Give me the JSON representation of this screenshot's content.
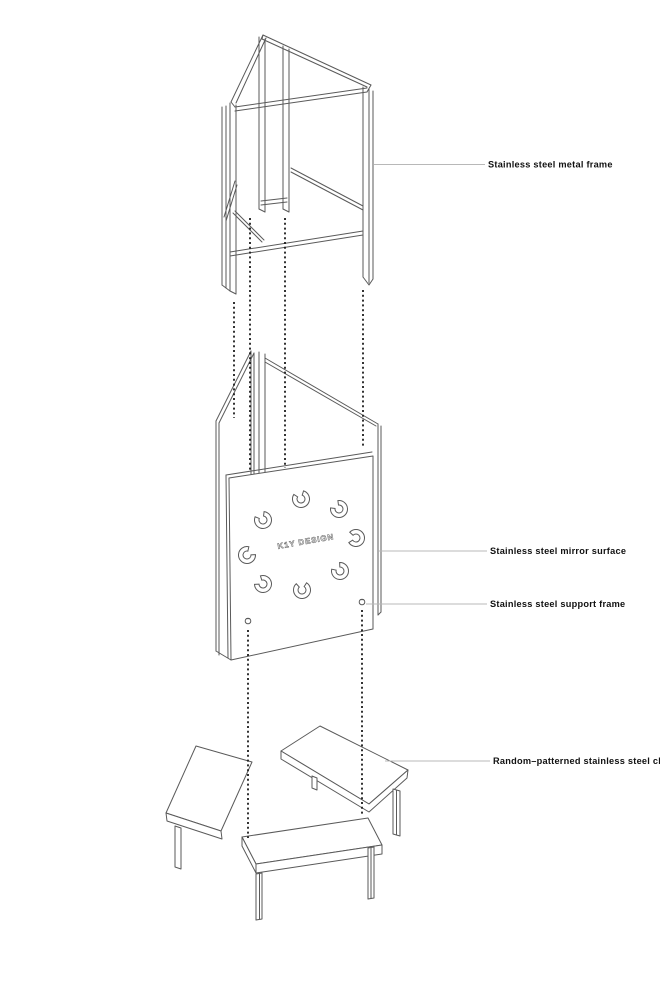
{
  "colors": {
    "line": "#5a5a5a",
    "leader": "#b8b8b8",
    "label_text": "#111111",
    "dotted": "#1c1c1c",
    "background": "#ffffff"
  },
  "annotations": [
    {
      "text": "Stainless steel metal frame"
    },
    {
      "text": "Stainless steel mirror surface"
    },
    {
      "text": "Stainless steel support frame"
    },
    {
      "text": "Random–patterned stainless steel chair"
    }
  ],
  "mirror_panel": {
    "brand_text": "K1Y DESIGN",
    "rings": [
      {
        "cx": 301,
        "cy": 499,
        "rot": 250
      },
      {
        "cx": 339,
        "cy": 509,
        "rot": 225
      },
      {
        "cx": 263,
        "cy": 520,
        "rot": 240
      },
      {
        "cx": 356,
        "cy": 538,
        "rot": 185
      },
      {
        "cx": 247,
        "cy": 555,
        "rot": 320
      },
      {
        "cx": 340,
        "cy": 571,
        "rot": 230
      },
      {
        "cx": 263,
        "cy": 584,
        "rot": 215
      },
      {
        "cx": 302,
        "cy": 590,
        "rot": 265
      }
    ]
  }
}
